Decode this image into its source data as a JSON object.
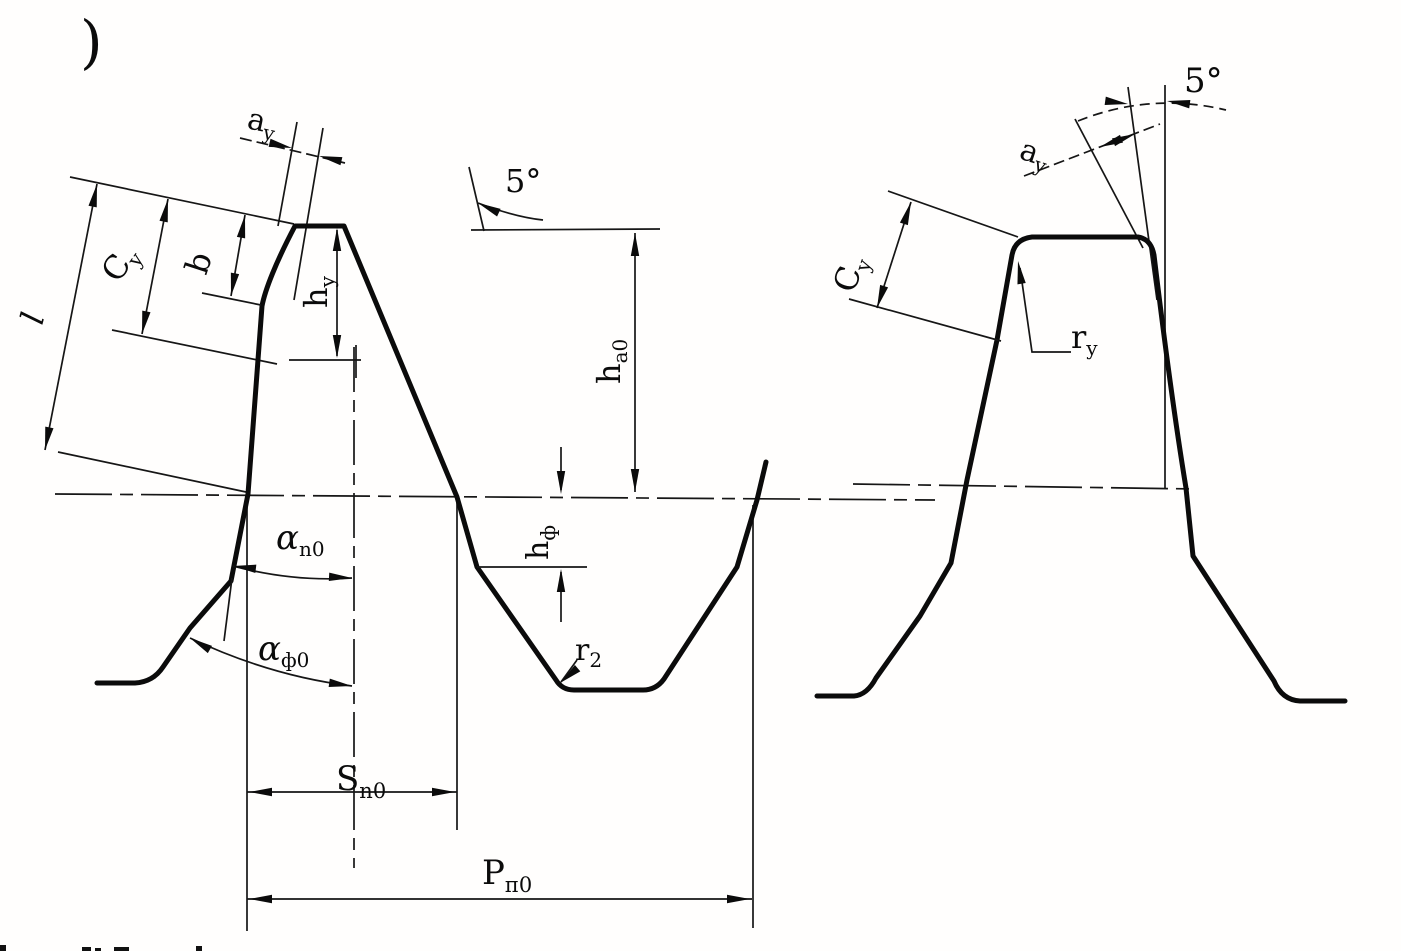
{
  "figure": {
    "corner_mark": ")",
    "left_view": {
      "labels": {
        "l": "l",
        "c_y": {
          "main": "C",
          "sub": "y"
        },
        "b": "b",
        "a_y": {
          "main": "a",
          "sub": "y"
        },
        "h_y": {
          "main": "h",
          "sub": "y"
        },
        "angle_5": "5°",
        "h_a0": {
          "main": "h",
          "sub": "а0"
        },
        "h_f": {
          "main": "h",
          "sub": "ф"
        },
        "r_2": {
          "main": "r",
          "sub": "2"
        },
        "alpha_n0": {
          "main": "α",
          "sub": "n0"
        },
        "alpha_f0": {
          "main": "α",
          "sub": "ф0"
        },
        "s_n0": {
          "main": "S",
          "sub": "n0"
        },
        "p_n0": {
          "main": "P",
          "sub": "п0"
        }
      }
    },
    "right_view": {
      "labels": {
        "angle_5": "5°",
        "a_y": {
          "main": "a",
          "sub": "y"
        },
        "c_y": {
          "main": "C",
          "sub": "y"
        },
        "r_y": {
          "main": "r",
          "sub": "y"
        }
      }
    }
  }
}
